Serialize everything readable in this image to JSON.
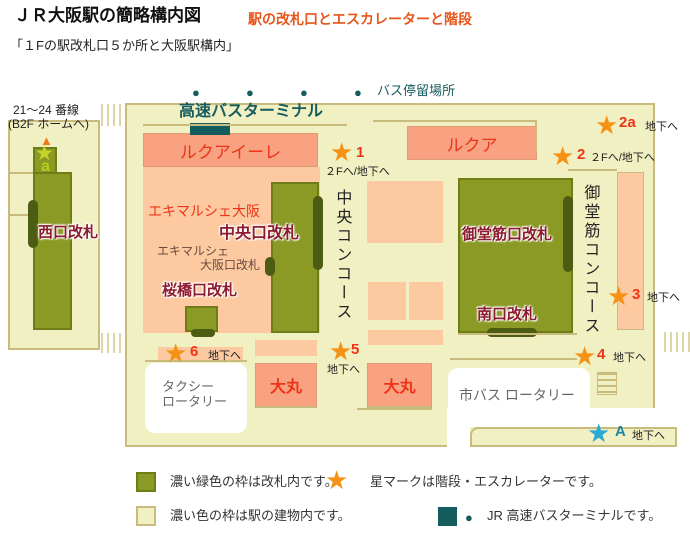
{
  "header": {
    "title": "ＪＲ大阪駅の簡略構内図",
    "subtitle": "駅の改札口とエスカレーターと階段",
    "caption": "「１Fの駅改札口５か所と大阪駅構内」"
  },
  "icons": {
    "star": "★",
    "triangle": "▲",
    "dot": "●"
  },
  "colors": {
    "accent_red": "#ee3418",
    "gate_text_darkred": "#8c1a30",
    "star_orange": "#f59114",
    "star_blue": "#29abd8",
    "star_yellow_green": "#bcd220",
    "teal": "#155c5e",
    "gate_green": "#8a9a24",
    "building_cream": "#f1f0c2",
    "building_border_tan": "#c9ba7e",
    "shop_salmon": "#f8a282",
    "shop_salmon_light": "#fcc9a0"
  },
  "map": {
    "bus_stop_label": "バス停留場所",
    "bus_terminal_label": "高速バスターミナル",
    "platform_line1": "21～24 番線",
    "platform_line2": "(B2F ホームへ)",
    "west_gate_label": "西口改札",
    "lucua_ile_label": "ルクアイーレ",
    "lucua_label": "ルクア",
    "ekimarche_label": "エキマルシェ大阪",
    "central_gate_label": "中央口改札",
    "ekimarche_gate_line1": "エキマルシェ",
    "ekimarche_gate_line2": "大阪口改札",
    "sakurabashi_gate_label": "桜橋口改札",
    "midosuji_gate_label": "御堂筋口改札",
    "south_gate_label": "南口改札",
    "central_concourse_label": "中央コンコース",
    "midosuji_concourse_label": "御堂筋コンコース",
    "taxi_line1": "タクシー",
    "taxi_line2": "ロータリー",
    "city_bus_label": "市バス ロータリー",
    "daimaru_left_label": "大丸",
    "daimaru_right_label": "大丸",
    "stars": {
      "s1": {
        "num": "1",
        "dest": "２Fへ/地下へ"
      },
      "s2": {
        "num": "2",
        "dest": "２Fへ/地下へ"
      },
      "s2a": {
        "num": "2a",
        "dest": "地下へ"
      },
      "s3": {
        "num": "3",
        "dest": "地下へ"
      },
      "s4": {
        "num": "4",
        "dest": "地下へ"
      },
      "s5": {
        "num": "5",
        "dest": "地下へ"
      },
      "s6": {
        "num": "6",
        "dest": "地下へ"
      },
      "sA": {
        "num": "A",
        "dest": "地下へ"
      },
      "sa": {
        "num": "a"
      }
    }
  },
  "legend": {
    "gate_inside": "濃い緑色の枠は改札内です。",
    "star_meaning": "星マークは階段・エスカレーターです。",
    "building_inside": "濃い色の枠は駅の建物内です。",
    "bus_terminal": "JR 高速バスターミナルです。"
  }
}
